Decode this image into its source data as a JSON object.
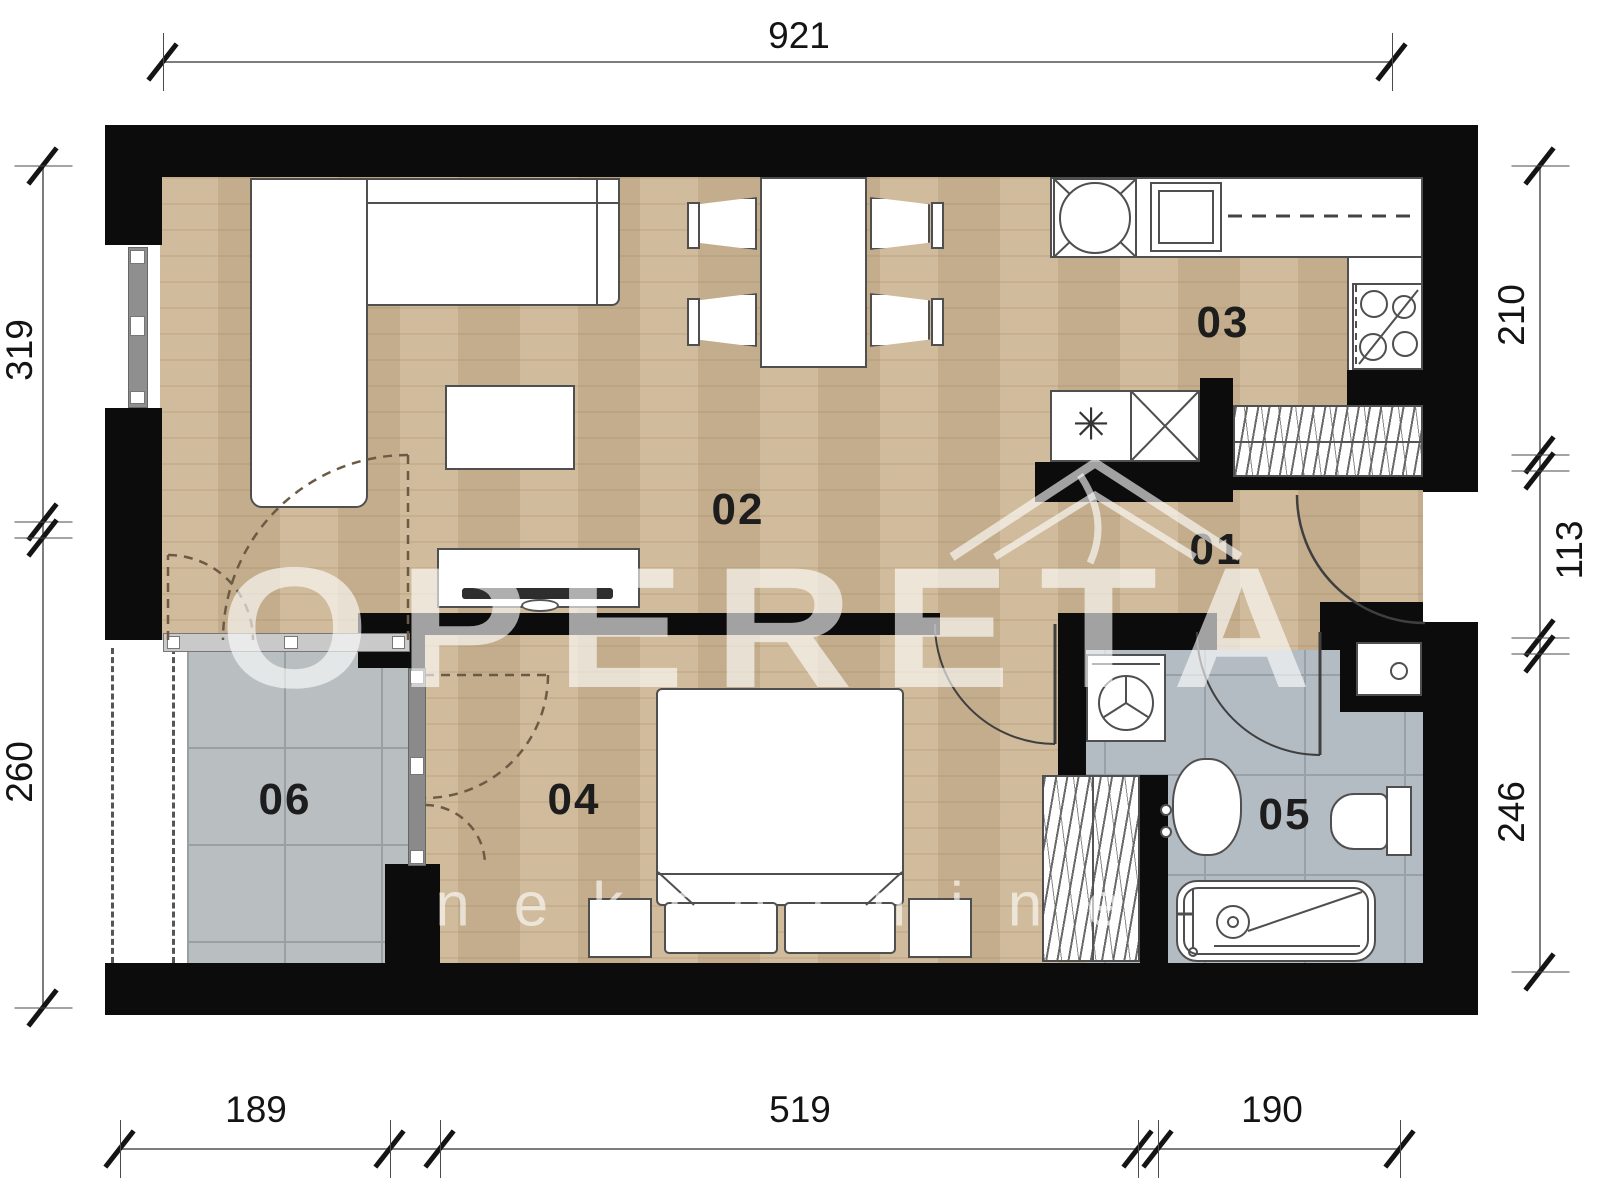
{
  "watermark": {
    "title": "OPERETA",
    "subtitle": "nekretnine"
  },
  "rooms": {
    "r01": "01",
    "r02": "02",
    "r03": "03",
    "r04": "04",
    "r05": "05",
    "r06": "06"
  },
  "dims": {
    "top": "921",
    "left_top": "319",
    "left_bottom": "260",
    "right_top": "210",
    "right_mid": "113",
    "right_bottom": "246",
    "bottom_left": "189",
    "bottom_mid": "519",
    "bottom_right": "190"
  },
  "symbols": {
    "freezer": "✳"
  },
  "colors": {
    "wall": "#0c0c0c",
    "wood": "#cdb694",
    "terrace_tile": "#b9bfc1",
    "bath_tile": "#b4bcc3",
    "watermark": "rgba(255,255,255,0.62)"
  }
}
